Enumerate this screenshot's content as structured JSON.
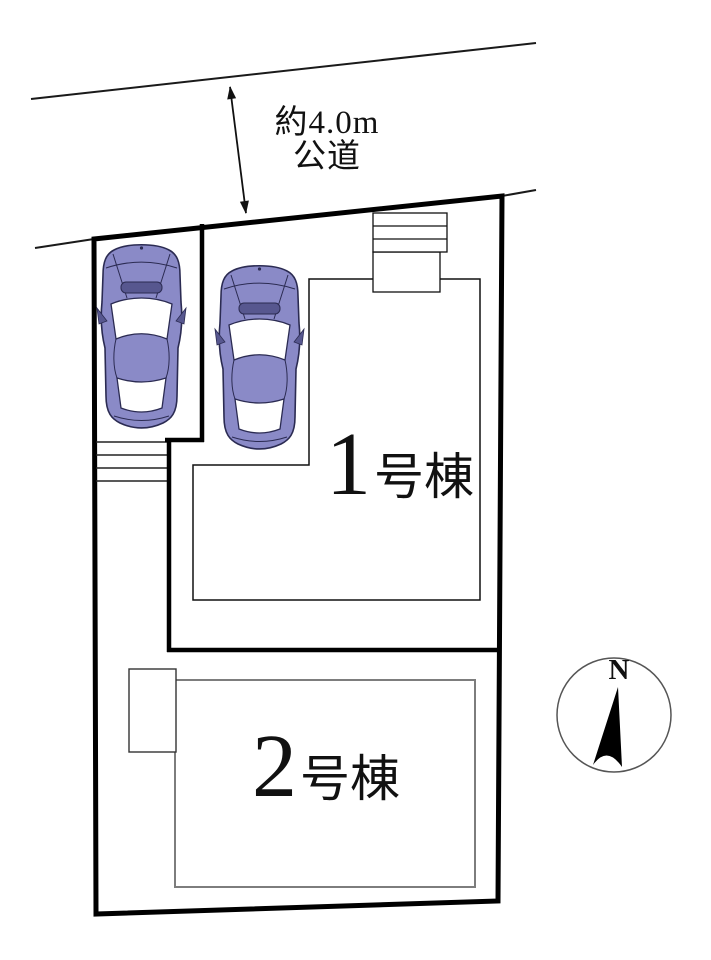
{
  "diagram": {
    "title": "site-plan",
    "road": {
      "width_label": "約4.0m",
      "type_label": "公道"
    },
    "units": [
      {
        "number": "1",
        "suffix": "号棟"
      },
      {
        "number": "2",
        "suffix": "号棟"
      }
    ],
    "parking": {
      "car_count": 2
    },
    "compass": {
      "north_label": "N"
    },
    "colors": {
      "background": "#ffffff",
      "line": "#111111",
      "building2_outline": "#7d7d7d",
      "car_body": "#8a8ac7",
      "car_accent": "#57578f",
      "car_outline": "#2b2b52"
    }
  }
}
